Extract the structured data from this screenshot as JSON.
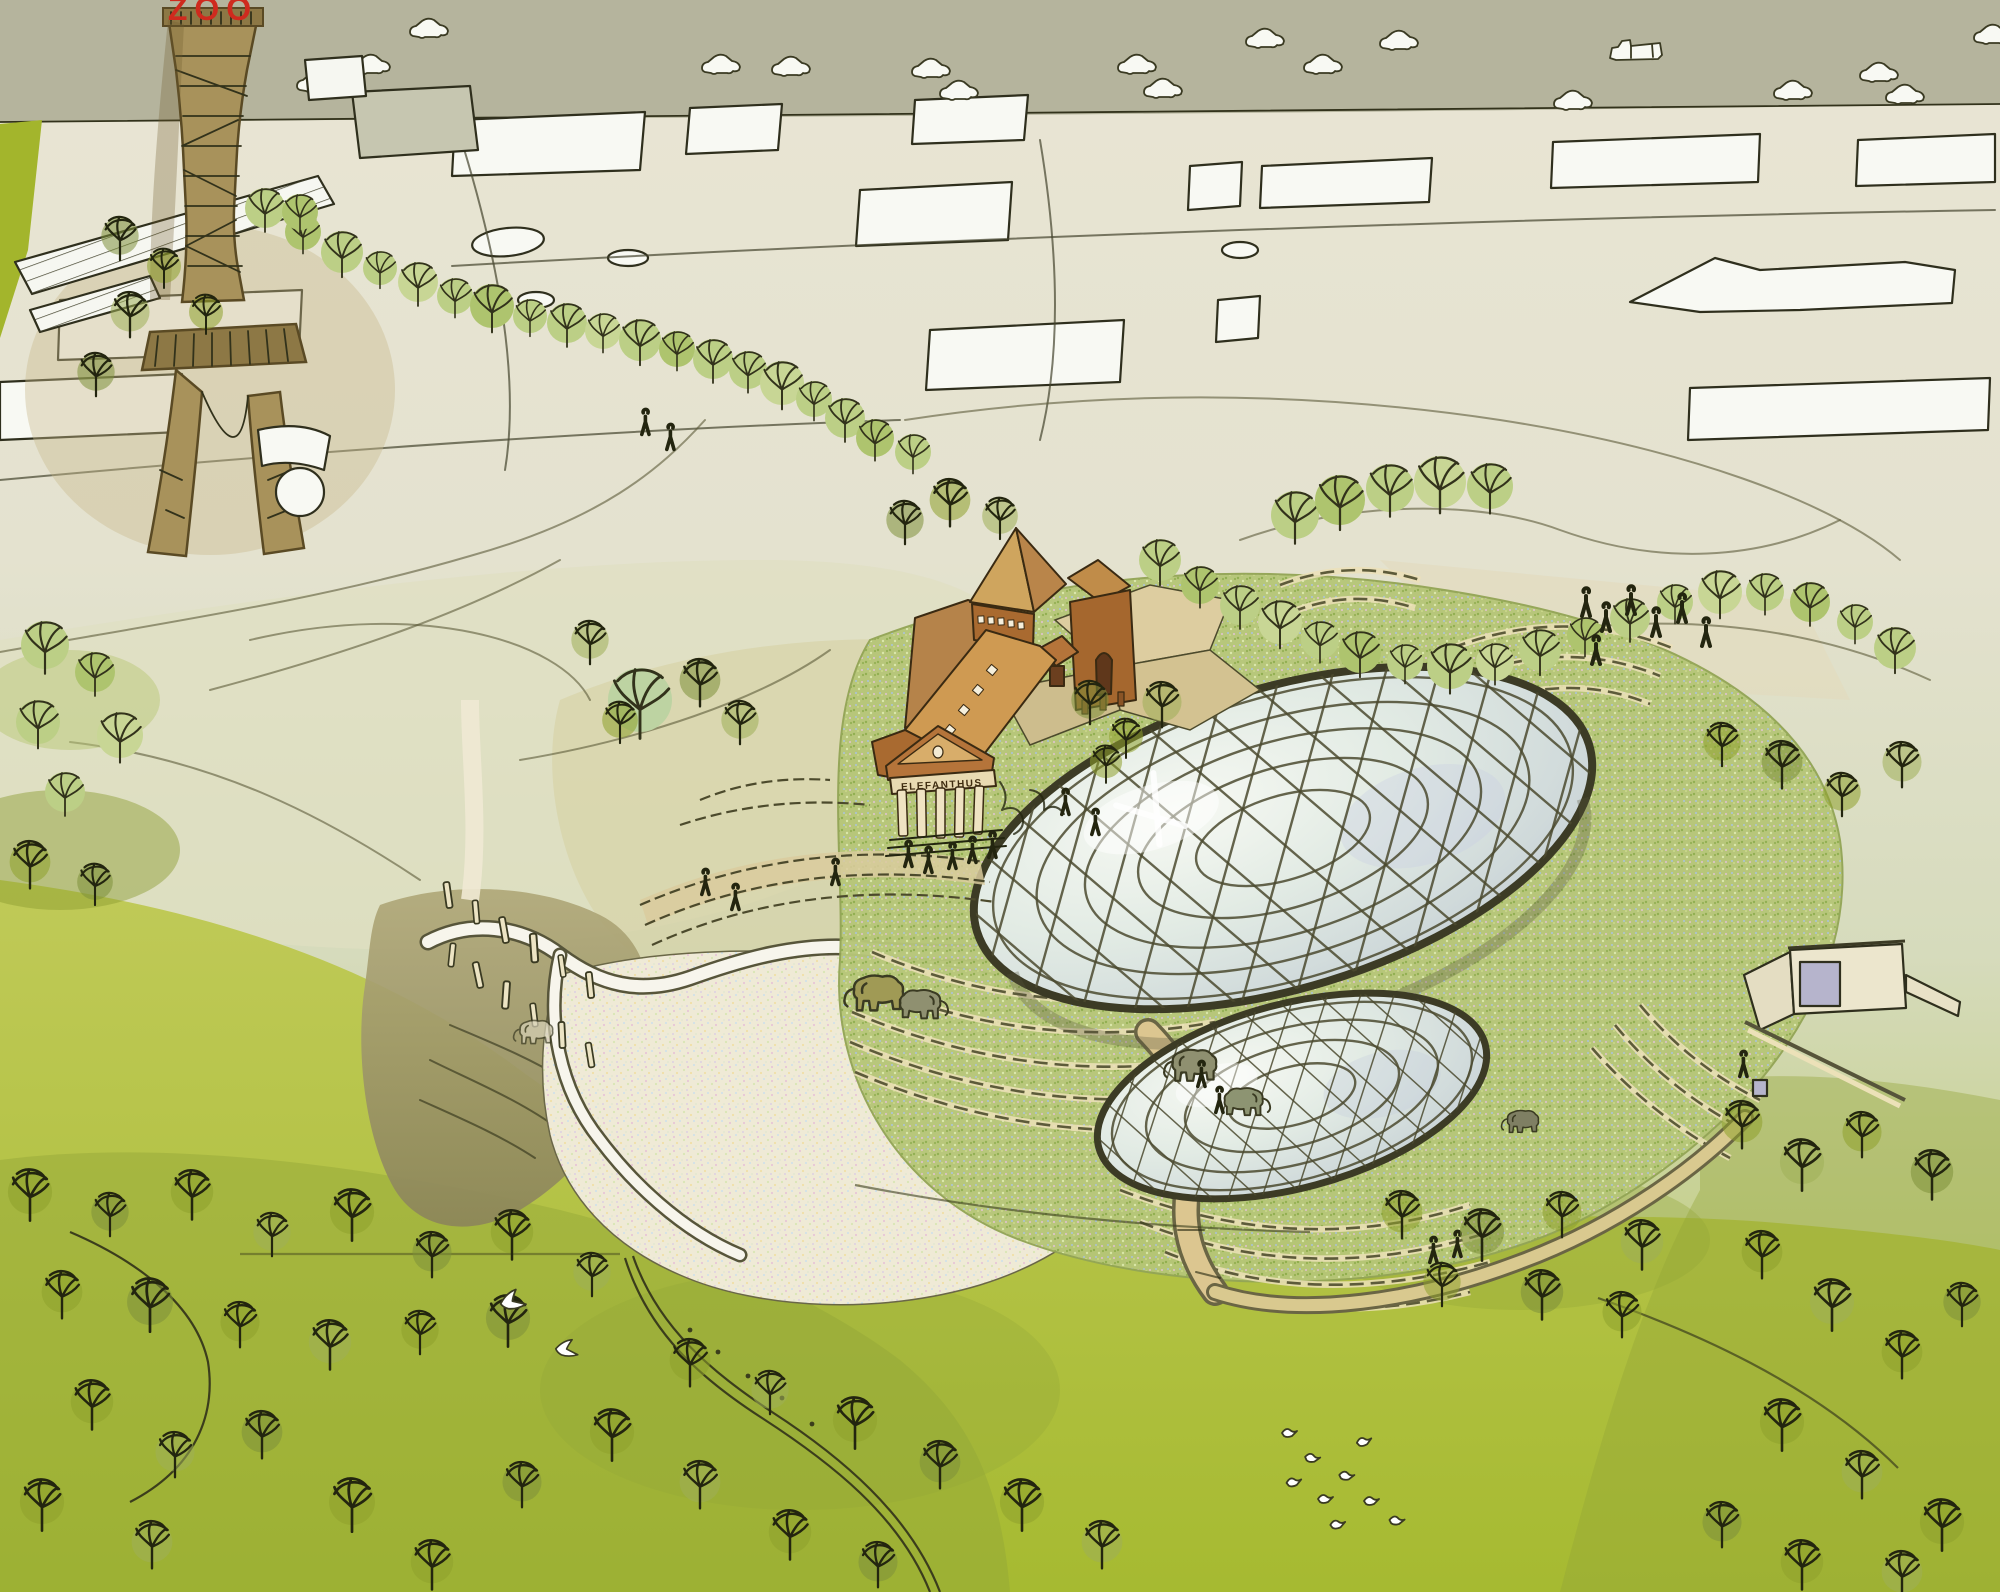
{
  "scene": {
    "tower_sign": "ZOO",
    "building_inscription": "ELEFANTHUS"
  },
  "palette": {
    "ink": "#32321b",
    "road": "#b5b49d",
    "city_ground": "#e9e4d2",
    "building_white": "#f8f9f3",
    "strip_green": "#a3b52c",
    "tower_brown": "#a8925b",
    "platform_brown": "#8d7845",
    "sign_red": "#cf2a1e",
    "glasshouse_white": "#f6f7f1",
    "tree_green": "#bccf86",
    "tree_green_light": "#c8d695",
    "tree_dark": "#8ea02c",
    "lawn_top": "#c0ca58",
    "lawn_bottom": "#a6ba31",
    "site_wash": "#dfe0c2",
    "brick_wall": "#a96a30",
    "roof_tan": "#cf9a52",
    "spire_tan": "#cfa55e",
    "pediment": "#b5743a",
    "architrave_cream": "#e9dab2",
    "column_cream": "#efe3c2",
    "inscription_ink": "#3f2c10",
    "door_brown": "#5f371b",
    "glass_pale": "#dce6e2",
    "lattice_olive": "#4b4a2f",
    "grass_roof": "#b6c678",
    "terrace_stone": "#5d5b3a",
    "sand": "#efead6",
    "mud": "#9a9166",
    "path_tan": "#dcc690",
    "moat_white": "#f7f5ec",
    "elephant_olive": "#a09a55",
    "elephant_grey": "#8f9070",
    "elephant_pale": "#d8d2b8",
    "service_wall": "#ece6cd",
    "window_lavender": "#b6b4cc",
    "bird_white": "#ffffff"
  }
}
